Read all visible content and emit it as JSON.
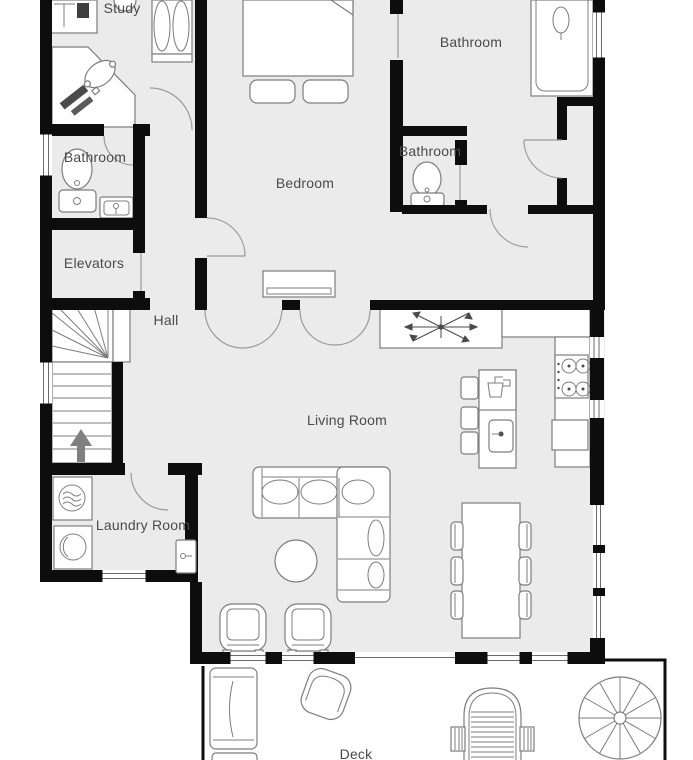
{
  "plan": {
    "type": "floor-plan",
    "floor_label": "",
    "rooms": [
      {
        "id": "study",
        "label": "Study"
      },
      {
        "id": "bathroom-top",
        "label": "Bathroom"
      },
      {
        "id": "bathroom-mid",
        "label": "Bathroom"
      },
      {
        "id": "bathroom-left",
        "label": "Bathroom"
      },
      {
        "id": "bedroom",
        "label": "Bedroom"
      },
      {
        "id": "elevators",
        "label": "Elevators"
      },
      {
        "id": "hall",
        "label": "Hall"
      },
      {
        "id": "living-room",
        "label": "Living Room"
      },
      {
        "id": "laundry-room",
        "label": "Laundry Room"
      },
      {
        "id": "deck",
        "label": "Deck"
      }
    ],
    "icons": [
      "bed-icon",
      "pillow-icon",
      "wardrobe-icon",
      "desk-icon",
      "office-chair-icon",
      "side-table-icon",
      "toilet-icon",
      "sink-icon",
      "bathtub-icon",
      "staircase-icon",
      "direction-arrow-icon",
      "washing-machine-icon",
      "dryer-icon",
      "door-icon",
      "sectional-sofa-icon",
      "coffee-table-icon",
      "armchair-icon",
      "dining-table-icon",
      "dining-chair-icon",
      "kitchen-island-icon",
      "bar-stool-icon",
      "stove-icon",
      "oven-icon",
      "ceiling-fan-icon",
      "kitchen-counter-icon",
      "lounge-chair-icon",
      "deck-chair-icon",
      "grill-icon",
      "spiral-staircase-icon"
    ],
    "colors": {
      "background": "#ffffff",
      "floor": "#ebebeb",
      "wall": "#0d0d0d",
      "furniture_outline": "#7d7d7d",
      "label": "#4a4a4a",
      "arrow": "#808080"
    }
  }
}
